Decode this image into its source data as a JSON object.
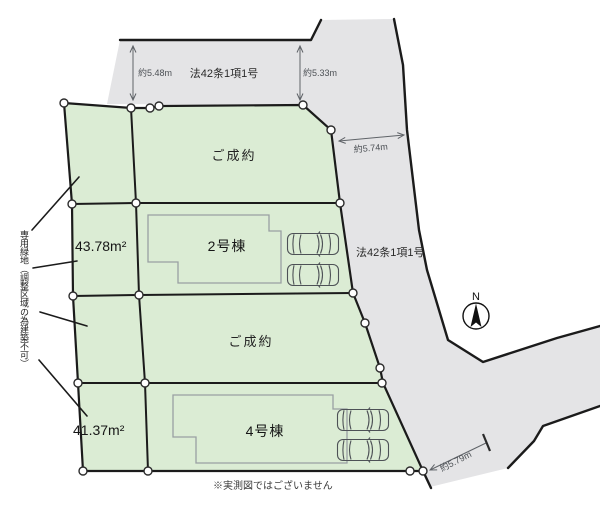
{
  "colors": {
    "background": "#ffffff",
    "plot_green": "#dbecd4",
    "road_gray": "#e4e4e6",
    "outline_black": "#1b1b1b",
    "house_outline": "#9aa0a2",
    "dimension_gray": "#5f6368"
  },
  "roads": {
    "top_law_label": "法42条1項1号",
    "right_law_label": "法42条1項1号"
  },
  "dimensions": {
    "top_left_width": "約5.48m",
    "top_right_width": "約5.33m",
    "right_width": "約5.74m",
    "bottom_width": "約5.79m"
  },
  "plots": [
    {
      "label": "ご成約"
    },
    {
      "area": "43.78m²",
      "building": "2号棟"
    },
    {
      "label": "ご成約"
    },
    {
      "area": "41.37m²",
      "building": "4号棟"
    }
  ],
  "compass": {
    "north_label": "N"
  },
  "notes": {
    "green_strip": "専用緑地（調整区域の為建築不可）",
    "disclaimer": "※実測図ではございません"
  }
}
